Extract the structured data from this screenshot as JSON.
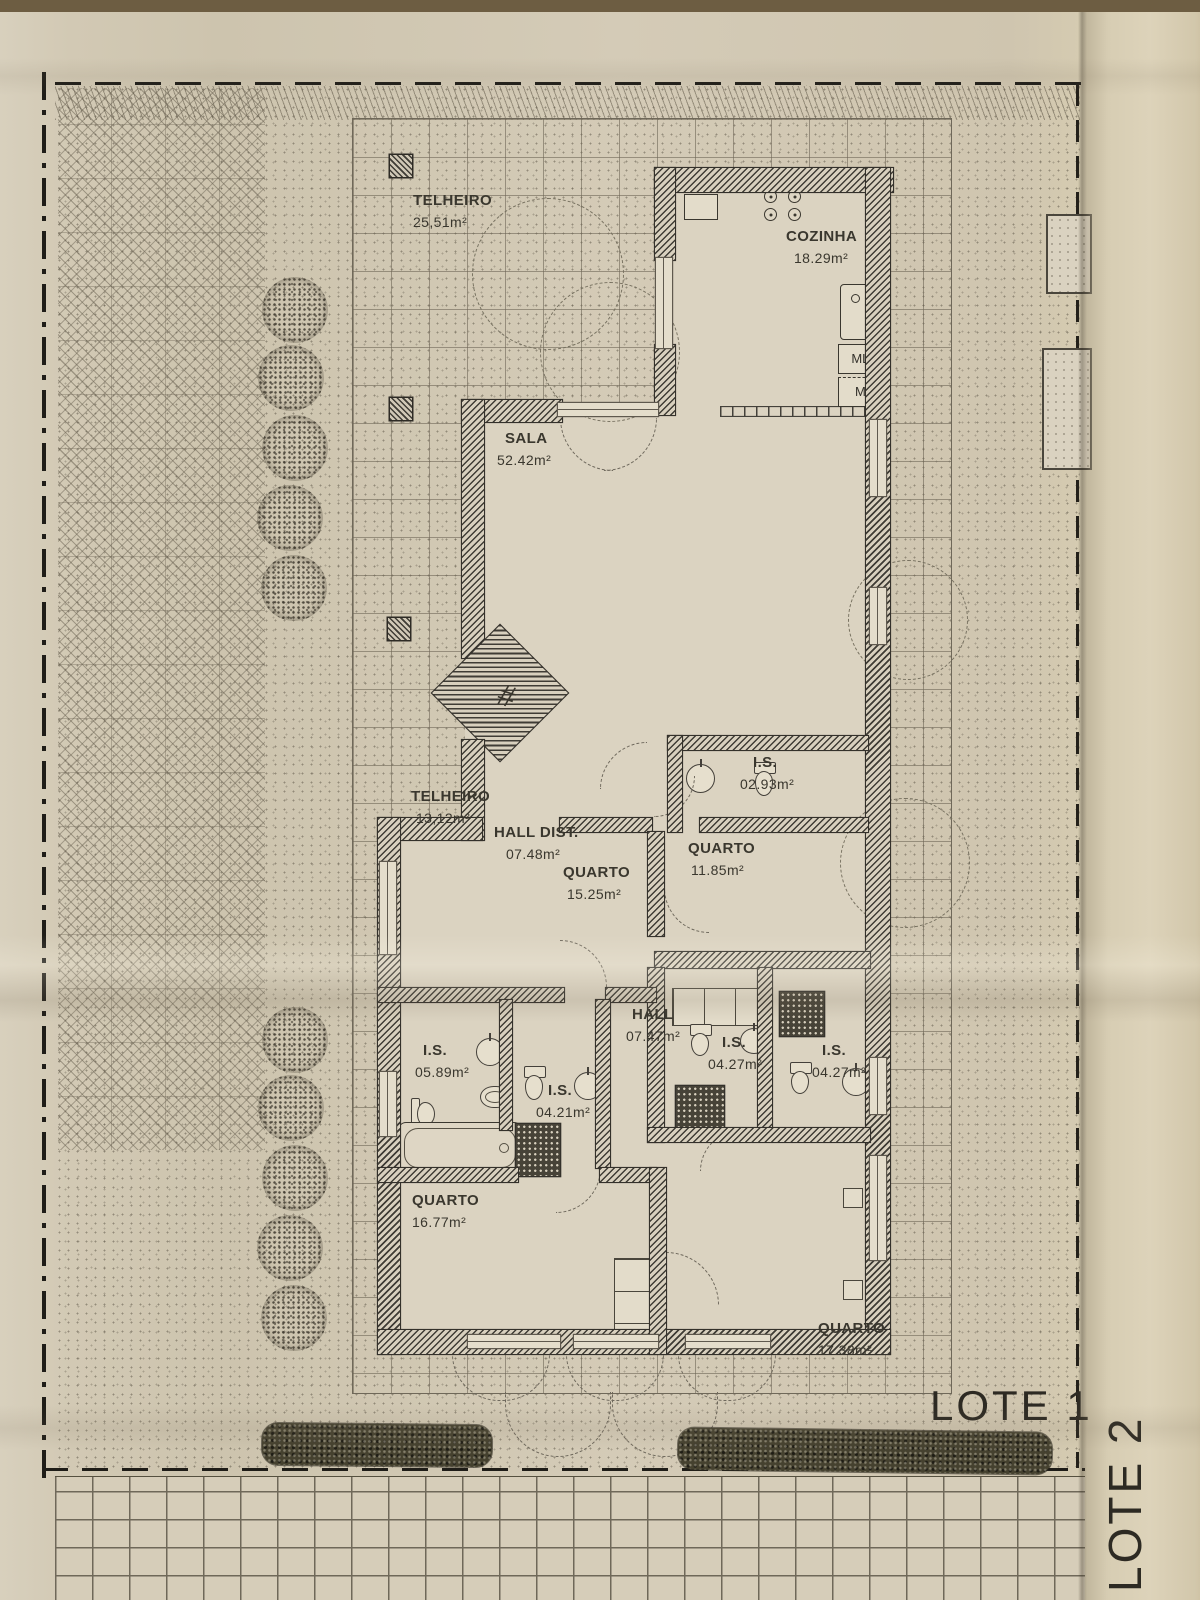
{
  "plan": {
    "rooms": [
      {
        "name": "TELHEIRO",
        "area": "25,51m²"
      },
      {
        "name": "COZINHA",
        "area": "18.29m²"
      },
      {
        "name": "SALA",
        "area": "52.42m²"
      },
      {
        "name": "TELHEIRO",
        "area": "13,12m²"
      },
      {
        "name": "HALL DIST.",
        "area": "07.48m²"
      },
      {
        "name": "QUARTO",
        "area": "15.25m²"
      },
      {
        "name": "I.S.",
        "area": "02.93m²"
      },
      {
        "name": "QUARTO",
        "area": "11.85m²"
      },
      {
        "name": "HALL",
        "area": "07.47m²"
      },
      {
        "name": "I.S.",
        "area": "05.89m²"
      },
      {
        "name": "I.S.",
        "area": "04.21m²"
      },
      {
        "name": "I.S.",
        "area": "04.27m²"
      },
      {
        "name": "I.S.",
        "area": "04.27m²"
      },
      {
        "name": "QUARTO",
        "area": "16.77m²"
      },
      {
        "name": "QUARTO",
        "area": "17.38m²"
      }
    ],
    "appliances": {
      "washer": "MLL",
      "dryer": "Mlr"
    },
    "lots": {
      "lote1": "LOTE 1",
      "lote2": "LOTE 2"
    },
    "symbols": {
      "fireplace": "#"
    },
    "colors": {
      "paper": "#d4cbb6",
      "ink": "#3a372e",
      "wall_hatch": "#3f3c35",
      "line": "#6f6859"
    }
  }
}
